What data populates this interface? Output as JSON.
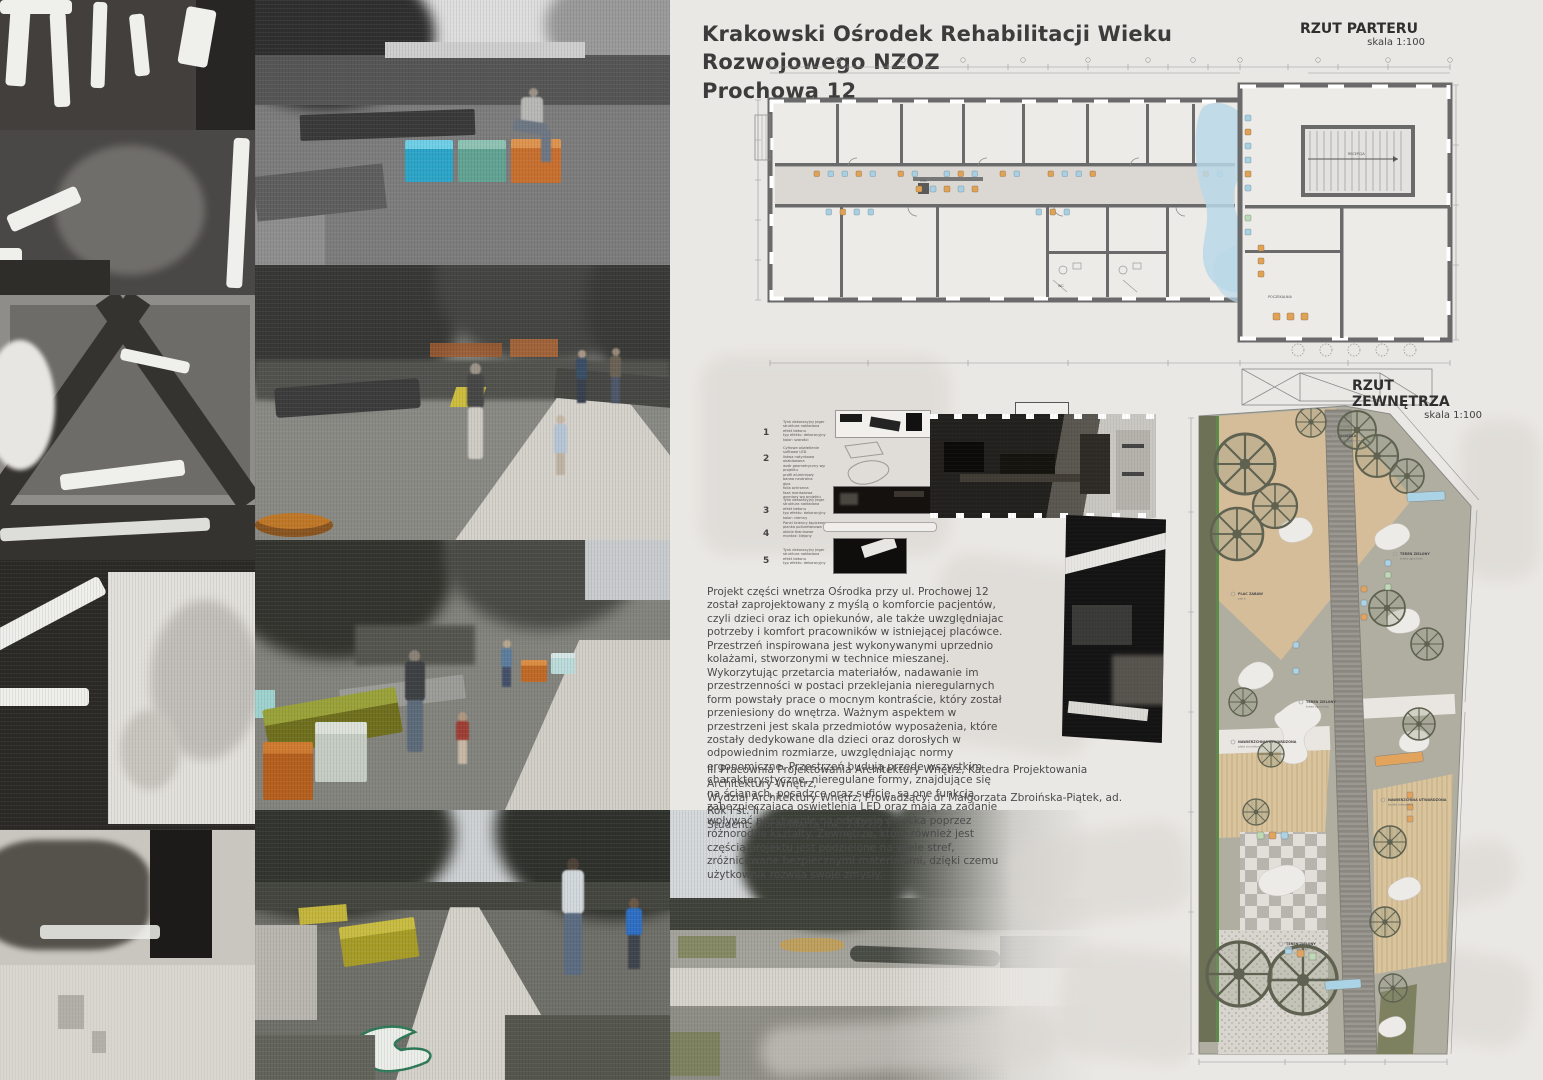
{
  "header": {
    "title_line1": "Krakowski Ośrodek Rehabilitacji Wieku Rozwojowego NZOZ",
    "title_line2": "Prochowa 12"
  },
  "floor_plan": {
    "label": "RZUT PARTERU",
    "scale": "skala 1:100",
    "room_labels": [
      "HOL",
      "RECEPCJA",
      "POCZEKALNIA",
      "WC"
    ]
  },
  "site_plan": {
    "label": "RZUT ZEWNĘTRZA",
    "scale": "skala 1:100",
    "labels": [
      {
        "title": "ŚCIEŻKA",
        "sub": "płyta betonowa"
      },
      {
        "title": "PLAC ZABAW",
        "sub": "piach"
      },
      {
        "title": "TEREN ZIELONY",
        "sub": "trawa ogrodowa"
      },
      {
        "title": "NAWIERZCHNIA UTWARDZONA",
        "sub": "płyta chodnikowa"
      },
      {
        "title": "TEREN ZIELONY",
        "sub": "trawa ogrodowa"
      },
      {
        "title": "NAWIERZCHNIA UTWARDZONA",
        "sub": "kostka drewniana"
      },
      {
        "title": "TEREN ZIELONY",
        "sub": "trawa ogrodowa"
      }
    ]
  },
  "legend": {
    "items": [
      {
        "num": "1",
        "text": "Tynk dekoracyjny Jeger\nstruktura nakładana\nefekt betonu\ntyp efektu: dekoracyjny\nkolor: szarości"
      },
      {
        "num": "2",
        "text": "Cyfrowe oświetlenie sufitowe LED\nlistwa natynkowa okablowana\nwzór geometryczny wg projektu\nprofil aluminiowy\nbarwa neutralna\ngips\nfolia ochronna\nfaza montażowa\nwymiary wg projektu"
      },
      {
        "num": "3",
        "text": "Tynk dekoracyjny Jeger\nstruktura nakładana\nefekt betonu\ntyp efektu: dekoracyjny\nkolor: ciemny"
      },
      {
        "num": "4",
        "text": "Panel ścienny tapicerowany\npianka poliuretanowa\nobicie tkaninowe\nmontaż: klejony"
      },
      {
        "num": "5",
        "text": "Tynk dekoracyjny Jeger\nstruktura nakładana\nefekt betonu\ntyp efektu: dekoracyjny"
      }
    ]
  },
  "description": {
    "paragraph": "Projekt części wnetrza Ośrodka przy ul. Prochowej 12 został zaprojektowany z myślą o komforcie pacjentów, czyli dzieci oraz ich opiekunów, ale także uwzględniajac potrzeby i komfort pracowników w istniejącej placówce. Przestrzeń inspirowana jest wykonywanymi uprzednio kolażami, stworzonymi w technice mieszanej. Wykorzytując przetarcia materiałów, nadawanie im przestrzenności w postaci przeklejania nieregularnych form powstały prace o mocnym kontraście, który został przeniesiony do wnętrza. Ważnym aspektem w przestrzeni jest skala przedmiotów wyposażenia, które zostały dedykowane dla dzieci oraz dorosłych w odpowiednim rozmiarze, uwzględniając normy ergonomiczne. Przestrzeń budują przede wszystkim charakterystyczne, nieregulane formy, znajdujące się na ścianach, posadzce oraz suficie, są one funkcją zabezpieczającą oswietlenia LED oraz mają za zadanie wpływać pozytywnie na odczucia dziecka poprzez różnorodne kształty. Zewnętrze, które również jest częścią projektu jest podzielone na wiele stref, zróżnicowane bezpiecznymi materiałami, dzięki czemu użytkownik rozwija swoje zmysły.",
    "credits": "III Pracownia Projektowania Architektury Wnętrz, Katedra Projektowania Architektury Wnętrz,\nWydział Architektury Wnętrz, Prowadzący: dr Małgorzata Zbroińska-Piątek, ad. Rok I st. II\nStudent: Gocał Marta rok. 2022/23"
  },
  "colors": {
    "board_bg": "#eae8e4",
    "cube_blue": "#2da5c8",
    "cube_teal": "#62a393",
    "cube_orange": "#c8702f",
    "bench_olive": "#8f9034",
    "bench_yellow": "#c9ba3a",
    "plan_wall": "#6a6a6a",
    "plan_water_blue": "#b9d8e8",
    "seat_orange": "#e0a257",
    "seat_blue": "#a9cfe2",
    "site_sand": "#d6bd9a",
    "site_grey_green": "#b0aea1",
    "site_olive_strip": "#6d7257",
    "site_wood": "#d9c49e"
  }
}
